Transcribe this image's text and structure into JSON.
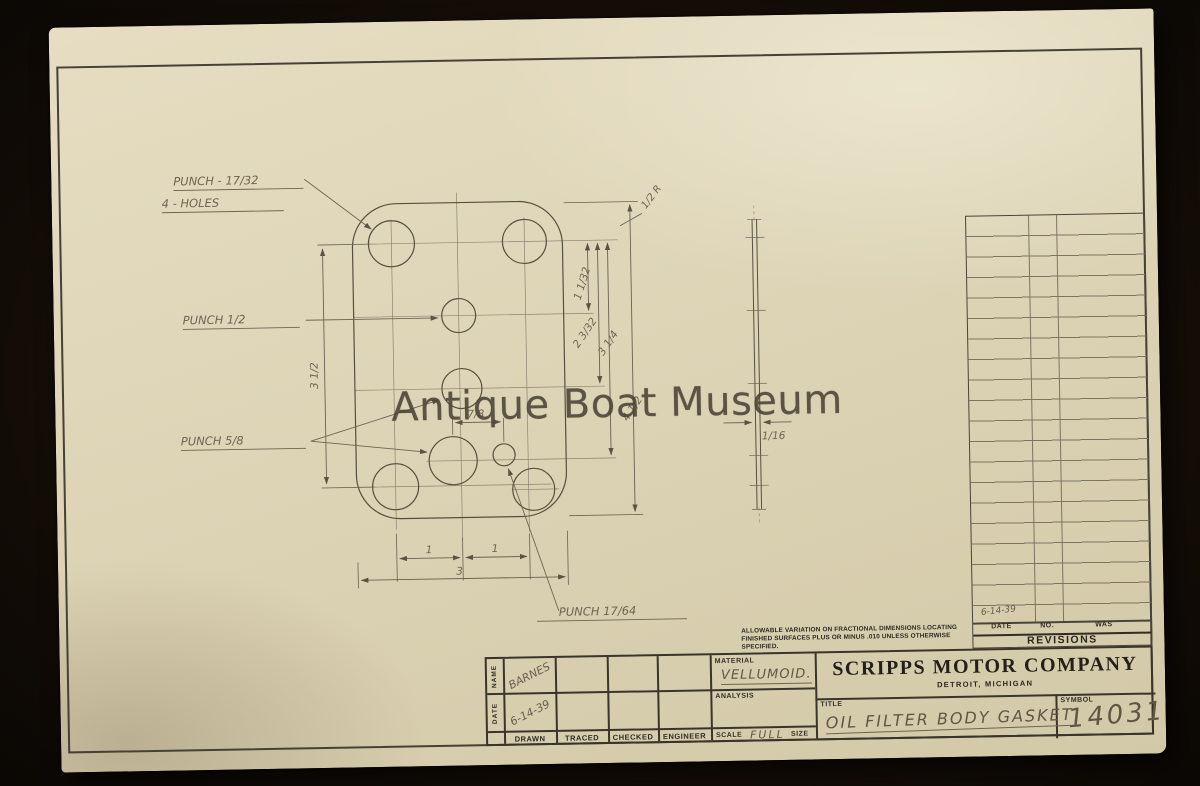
{
  "watermark": "Antique Boat Museum",
  "annotations": {
    "punch_17_32_line1": "PUNCH - 17/32",
    "punch_17_32_line2": "4 - HOLES",
    "punch_half": "PUNCH 1/2",
    "punch_5_8": "PUNCH 5/8",
    "punch_17_64": "PUNCH 17/64",
    "corner_radius": "1/2 R"
  },
  "dimensions": {
    "left_height": "3 1/2",
    "right_v1": "1 1/32",
    "right_v2": "2 3/32",
    "right_v3": "3 1/4",
    "right_overall": "4 1/2",
    "hole_spacing": "7/8",
    "bottom_seg1": "1",
    "bottom_seg2": "1",
    "bottom_overall": "3",
    "thickness": "1/16"
  },
  "tolerance_note": {
    "line1": "ALLOWABLE VARIATION ON FRACTIONAL DIMENSIONS LOCATING",
    "line2": "FINISHED SURFACES PLUS OR MINUS .010 UNLESS OTHERWISE",
    "line3": "SPECIFIED."
  },
  "revisions": {
    "title": "REVISIONS",
    "col_date": "DATE",
    "col_no": "NO.",
    "col_was": "WAS",
    "entry_date": "6-14-39"
  },
  "title_block": {
    "name_label": "NAME",
    "date_label": "DATE",
    "name_value": "BARNES",
    "date_value": "6-14-39",
    "drawn_label": "DRAWN",
    "traced_label": "TRACED",
    "checked_label": "CHECKED",
    "engineer_label": "ENGINEER",
    "material_label": "MATERIAL",
    "material_value": "VELLUMOID.",
    "analysis_label": "ANALYSIS",
    "scale_label": "SCALE",
    "scale_value": "FULL",
    "size_label": "SIZE",
    "company_name": "SCRIPPS MOTOR COMPANY",
    "company_city": "DETROIT, MICHIGAN",
    "title_label": "TITLE",
    "title_value": "OIL FILTER BODY GASKET",
    "symbol_label": "SYMBOL",
    "symbol_value": "14031"
  }
}
